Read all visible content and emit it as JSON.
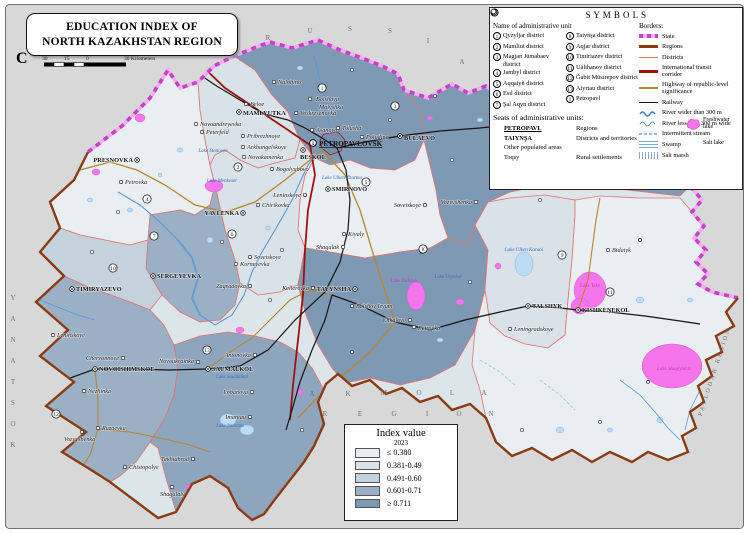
{
  "frame": {
    "title_line1": "EDUCATION INDEX OF",
    "title_line2": "NORTH KAZAKHSTAN REGION",
    "north_letter": "C",
    "scale": {
      "ticks": [
        "30",
        "15",
        "0"
      ],
      "right_label": "30 Kilometers"
    }
  },
  "symbols_panel": {
    "title": "S Y M B O L S",
    "admin_header": "Name of administrative unit",
    "districts_col1": [
      {
        "num": "1",
        "label": "Qyzyljar district"
      },
      {
        "num": "2",
        "label": "Mamliut district"
      },
      {
        "num": "3",
        "label": "Magjan Jūmabaev district"
      },
      {
        "num": "4",
        "label": "Jambyl district"
      },
      {
        "num": "5",
        "label": "Aqqaiyñ district"
      },
      {
        "num": "6",
        "label": "Esıl district"
      },
      {
        "num": "7",
        "label": "Şal Aqyn district"
      }
    ],
    "districts_col2": [
      {
        "num": "8",
        "label": "Taiynşa district"
      },
      {
        "num": "9",
        "label": "Aqjar district"
      },
      {
        "num": "10",
        "label": "Timiriazev district"
      },
      {
        "num": "11",
        "label": "Uälihanov district"
      },
      {
        "num": "12",
        "label": "Ğabit Müsırepov district"
      },
      {
        "num": "13",
        "label": "Aiyrtau district"
      },
      {
        "num": "I",
        "label": "Petropavl"
      }
    ],
    "seats_header": "Seats of administrative units:",
    "seats": [
      {
        "symbol": "region-seat",
        "sample": "PETROPAVL",
        "desc": "Regions"
      },
      {
        "symbol": "district-seat",
        "sample": "TAIYNŞA",
        "desc": "Districts and territories"
      }
    ],
    "other_line": "Other populated areas",
    "rural": {
      "symbol": "village",
      "sample": "Toqsy",
      "desc": "Rural settlements"
    },
    "borders_header": "Borders:",
    "border_items": [
      {
        "type": "state",
        "label": "State"
      },
      {
        "type": "regions",
        "label": "Regions"
      },
      {
        "type": "districts",
        "label": "Districts"
      },
      {
        "type": "transit",
        "label": "International transit corridor"
      },
      {
        "type": "highway",
        "label": "Highway of republic-level significance"
      },
      {
        "type": "railway",
        "label": "Railway"
      },
      {
        "type": "river-wide",
        "label": "River wider than 300 m"
      },
      {
        "type": "river-narrow",
        "label": "River less than 300 m wide"
      },
      {
        "type": "stream",
        "label": "Intermittent stream"
      },
      {
        "type": "swamp",
        "label": "Swamp"
      },
      {
        "type": "saltmarsh",
        "label": "Salt marsh"
      }
    ],
    "lake_items": [
      {
        "type": "fresh",
        "label": "Freshwater lake"
      },
      {
        "type": "salt",
        "label": "Salt lake"
      }
    ]
  },
  "index_legend": {
    "title": "Index value",
    "year": "2023",
    "classes": [
      {
        "label": "≤ 0.380",
        "color": "#e8eef1"
      },
      {
        "label": "0.381-0.49",
        "color": "#d9e2e8"
      },
      {
        "label": "0.491-0.60",
        "color": "#c3d2dc"
      },
      {
        "label": "0.601-0.71",
        "color": "#9ab0c5"
      },
      {
        "label": "≥ 0.711",
        "color": "#7e99b4"
      }
    ]
  },
  "colors": {
    "c1": "#e8eef1",
    "c2": "#d9e2e8",
    "c3": "#c3d2dc",
    "c4": "#9ab0c5",
    "c4b": "#8ea6bd",
    "c5": "#7e99b4",
    "base": "#dce5ea",
    "bg": "#d8d8d8",
    "water_fill": "#bbdcf2",
    "water_stroke": "#78abd8",
    "river": "#5a98d9",
    "salt_fill": "#f476ea",
    "salt_stroke": "#d94fd0",
    "state_dash": "#c83fca",
    "state_band": "#f2aeee",
    "region_border": "#8a3b12",
    "district_border": "#e0746e",
    "corridor": "#9e120e",
    "highway": "#b98530",
    "railway": "#141414"
  },
  "neighbors": {
    "russia": [
      [
        "R",
        268,
        40
      ],
      [
        "U",
        310,
        33
      ],
      [
        "S",
        350,
        31
      ],
      [
        "S",
        390,
        33
      ],
      [
        "I",
        428,
        43
      ],
      [
        "A",
        462,
        64
      ]
    ],
    "akmola_row1": [
      [
        "A",
        312,
        396
      ],
      [
        "K",
        348,
        396
      ],
      [
        "M",
        384,
        395
      ],
      [
        "O",
        419,
        395
      ],
      [
        "L",
        452,
        395
      ],
      [
        "A",
        484,
        395
      ]
    ],
    "akmola_row2": [
      [
        "R",
        325,
        416
      ],
      [
        "E",
        360,
        416
      ],
      [
        "G",
        394,
        416
      ],
      [
        "I",
        427,
        416
      ],
      [
        "O",
        459,
        416
      ],
      [
        "N",
        491,
        416
      ]
    ],
    "kostanay": [
      [
        "Y",
        13,
        300
      ],
      [
        "A",
        13,
        321
      ],
      [
        "N",
        13,
        342
      ],
      [
        "A",
        13,
        363
      ],
      [
        "T",
        13,
        384
      ],
      [
        "S",
        13,
        405
      ],
      [
        "O",
        13,
        426
      ],
      [
        "K",
        13,
        447
      ]
    ],
    "pavlodar": {
      "text": "PAVLODAR REGION",
      "x": 716,
      "y": 372,
      "rot": -72
    }
  },
  "map_features": {
    "towns": [
      {
        "n": "PETROPAVLOVSK",
        "x": 313,
        "y": 143,
        "t": "city",
        "lx": 319,
        "ly": 146
      },
      {
        "n": "BESKOL",
        "x": 303,
        "y": 150,
        "t": "seat",
        "lx": 300,
        "ly": 159
      },
      {
        "n": "MAMLYUTKA",
        "x": 239,
        "y": 112,
        "t": "seat",
        "lx": 243,
        "ly": 115
      },
      {
        "n": "BULAEVO",
        "x": 400,
        "y": 136,
        "t": "seat",
        "lx": 404,
        "ly": 140
      },
      {
        "n": "PRESNOVKA",
        "x": 137,
        "y": 160,
        "t": "seat",
        "lx": 133,
        "ly": 162,
        "a": "end"
      },
      {
        "n": "SMIRNOVO",
        "x": 328,
        "y": 189,
        "t": "seat",
        "lx": 332,
        "ly": 191
      },
      {
        "n": "YAVLENKA",
        "x": 243,
        "y": 213,
        "t": "seat",
        "lx": 239,
        "ly": 215,
        "a": "end"
      },
      {
        "n": "SERGEYEVKA",
        "x": 153,
        "y": 276,
        "t": "seat",
        "lx": 157,
        "ly": 278
      },
      {
        "n": "TAYYNSHA",
        "x": 355,
        "y": 289,
        "t": "seat",
        "lx": 351,
        "ly": 291,
        "a": "end"
      },
      {
        "n": "TIMIRYAZEVO",
        "x": 72,
        "y": 289,
        "t": "seat",
        "lx": 76,
        "ly": 291
      },
      {
        "n": "NOVOISHIMSKOE",
        "x": 95,
        "y": 369,
        "t": "seat",
        "lx": 99,
        "ly": 371
      },
      {
        "n": "SAUMALKOL",
        "x": 208,
        "y": 369,
        "t": "seat",
        "lx": 212,
        "ly": 371
      },
      {
        "n": "TALSHYK",
        "x": 528,
        "y": 306,
        "t": "seat",
        "lx": 532,
        "ly": 308
      },
      {
        "n": "KISHKENEKOL",
        "x": 578,
        "y": 310,
        "t": "seat",
        "lx": 582,
        "ly": 312
      },
      {
        "n": "Nalobino",
        "x": 274,
        "y": 82,
        "t": "vil",
        "lx": 278,
        "ly": 84
      },
      {
        "n": "Beloe",
        "x": 246,
        "y": 104,
        "t": "vil",
        "lx": 250,
        "ly": 106
      },
      {
        "n": "Voskresenovka",
        "x": 296,
        "y": 113,
        "t": "vil",
        "lx": 300,
        "ly": 115
      },
      {
        "n": "Bolshaya",
        "n2": "Malyshka",
        "x": 310,
        "y": 99,
        "lx": 316,
        "ly": 101,
        "l2x": 319,
        "l2y": 109,
        "t": "vil"
      },
      {
        "n": "Pribrezhnoye",
        "x": 243,
        "y": 136,
        "t": "vil",
        "lx": 247,
        "ly": 138
      },
      {
        "n": "Asanovo",
        "x": 312,
        "y": 130,
        "t": "vil",
        "lx": 316,
        "ly": 132
      },
      {
        "n": "Tolusha",
        "x": 338,
        "y": 128,
        "t": "vil",
        "lx": 342,
        "ly": 130
      },
      {
        "n": "Poludino",
        "x": 362,
        "y": 137,
        "t": "vil",
        "lx": 366,
        "ly": 139
      },
      {
        "n": "Arkhangelskoye",
        "x": 243,
        "y": 147,
        "t": "vil",
        "lx": 247,
        "ly": 149
      },
      {
        "n": "Novokamenka",
        "x": 244,
        "y": 157,
        "t": "vil",
        "lx": 248,
        "ly": 159
      },
      {
        "n": "Novoandreyevka",
        "x": 196,
        "y": 124,
        "t": "vil",
        "lx": 200,
        "ly": 126
      },
      {
        "n": "Peterfeld",
        "x": 202,
        "y": 132,
        "t": "vil",
        "lx": 206,
        "ly": 134
      },
      {
        "n": "Bogolyubovo",
        "x": 272,
        "y": 169,
        "t": "vil",
        "lx": 276,
        "ly": 171
      },
      {
        "n": "Leninskoye",
        "x": 305,
        "y": 195,
        "t": "vil",
        "lx": 301,
        "ly": 197,
        "a": "end"
      },
      {
        "n": "Chirikovka",
        "x": 258,
        "y": 205,
        "t": "vil",
        "lx": 262,
        "ly": 207
      },
      {
        "n": "Kiyaly",
        "x": 344,
        "y": 234,
        "t": "vil",
        "lx": 348,
        "ly": 236
      },
      {
        "n": "Shagalak",
        "x": 343,
        "y": 247,
        "t": "vil",
        "lx": 339,
        "ly": 249,
        "a": "end"
      },
      {
        "n": "Sovetskoye",
        "x": 250,
        "y": 257,
        "t": "vil",
        "lx": 254,
        "ly": 259
      },
      {
        "n": "Korneyevka",
        "x": 236,
        "y": 264,
        "t": "vil",
        "lx": 240,
        "ly": 266
      },
      {
        "n": "Zagradovka",
        "x": 250,
        "y": 286,
        "t": "vil",
        "lx": 246,
        "ly": 288,
        "a": "end"
      },
      {
        "n": "Kellerovka",
        "x": 313,
        "y": 288,
        "t": "vil",
        "lx": 309,
        "ly": 290,
        "a": "end"
      },
      {
        "n": "Bolshoy Izyum",
        "x": 352,
        "y": 306,
        "t": "vil",
        "lx": 356,
        "ly": 308
      },
      {
        "n": "Chkalovo",
        "x": 410,
        "y": 320,
        "t": "vil",
        "lx": 406,
        "ly": 322,
        "a": "end"
      },
      {
        "n": "Petrovka",
        "x": 414,
        "y": 327,
        "t": "vil",
        "lx": 418,
        "ly": 330
      },
      {
        "n": "Sovetskoye",
        "x": 425,
        "y": 205,
        "t": "vil",
        "lx": 421,
        "ly": 207,
        "a": "end"
      },
      {
        "n": "Vozvyshenka",
        "x": 476,
        "y": 202,
        "t": "vil",
        "lx": 472,
        "ly": 204,
        "a": "end"
      },
      {
        "n": "Bidaiyk",
        "x": 608,
        "y": 250,
        "t": "vil",
        "lx": 612,
        "ly": 252
      },
      {
        "n": "Leningradskoye",
        "x": 510,
        "y": 329,
        "t": "vil",
        "lx": 514,
        "ly": 331
      },
      {
        "n": "Chervonnoye",
        "x": 123,
        "y": 358,
        "t": "vil",
        "lx": 119,
        "ly": 360,
        "a": "end"
      },
      {
        "n": "Leninskoye",
        "x": 53,
        "y": 335,
        "t": "vil",
        "lx": 57,
        "ly": 337
      },
      {
        "n": "Nezhinka",
        "x": 84,
        "y": 391,
        "t": "vil",
        "lx": 88,
        "ly": 393
      },
      {
        "n": "Novoukrainka",
        "x": 198,
        "y": 362,
        "t": "vil",
        "lx": 194,
        "ly": 363,
        "a": "end"
      },
      {
        "n": "Antonovka",
        "x": 255,
        "y": 355,
        "t": "vil",
        "lx": 251,
        "ly": 357,
        "a": "end"
      },
      {
        "n": "Lobanova",
        "x": 252,
        "y": 392,
        "t": "vil",
        "lx": 248,
        "ly": 394,
        "a": "end"
      },
      {
        "n": "Imantau",
        "x": 250,
        "y": 417,
        "t": "vil",
        "lx": 246,
        "ly": 419,
        "a": "end"
      },
      {
        "n": "Ruzaevka",
        "x": 98,
        "y": 428,
        "t": "vil",
        "lx": 102,
        "ly": 430
      },
      {
        "n": "Vozvyshenka",
        "x": 82,
        "y": 432,
        "t": "vil",
        "lx": 64,
        "ly": 441
      },
      {
        "n": "Chistopolye",
        "x": 125,
        "y": 467,
        "t": "vil",
        "lx": 129,
        "ly": 469
      },
      {
        "n": "Takhtabrod",
        "x": 193,
        "y": 459,
        "t": "vil",
        "lx": 189,
        "ly": 461,
        "a": "end"
      },
      {
        "n": "Shagalaly",
        "x": 172,
        "y": 487,
        "t": "vil",
        "lx": 160,
        "ly": 496
      },
      {
        "n": "Petrovka",
        "x": 121,
        "y": 182,
        "t": "vil",
        "lx": 125,
        "ly": 184
      }
    ],
    "dots": [
      [
        352,
        70
      ],
      [
        390,
        120
      ],
      [
        452,
        160
      ],
      [
        500,
        152
      ],
      [
        558,
        140
      ],
      [
        620,
        142
      ],
      [
        662,
        152
      ],
      [
        282,
        250
      ],
      [
        222,
        242
      ],
      [
        118,
        212
      ],
      [
        92,
        252
      ],
      [
        422,
        252
      ],
      [
        470,
        282
      ],
      [
        352,
        352
      ],
      [
        302,
        430
      ],
      [
        522,
        430
      ],
      [
        600,
        422
      ],
      [
        648,
        382
      ],
      [
        270,
        300
      ],
      [
        435,
        96
      ],
      [
        540,
        200
      ],
      [
        640,
        240
      ]
    ],
    "district_numbers": [
      {
        "n": "1",
        "x": 322,
        "y": 88
      },
      {
        "n": "2",
        "x": 238,
        "y": 167
      },
      {
        "n": "3",
        "x": 395,
        "y": 106
      },
      {
        "n": "4",
        "x": 147,
        "y": 199
      },
      {
        "n": "5",
        "x": 366,
        "y": 182
      },
      {
        "n": "6",
        "x": 232,
        "y": 234
      },
      {
        "n": "7",
        "x": 154,
        "y": 236
      },
      {
        "n": "8",
        "x": 423,
        "y": 249
      },
      {
        "n": "9",
        "x": 562,
        "y": 255
      },
      {
        "n": "10",
        "x": 113,
        "y": 268
      },
      {
        "n": "11",
        "x": 610,
        "y": 292
      },
      {
        "n": "12",
        "x": 56,
        "y": 414
      },
      {
        "n": "13",
        "x": 207,
        "y": 350
      }
    ],
    "lake_labels": [
      {
        "n": "Lake Stanovoe",
        "x": 213,
        "y": 152,
        "c": "fresh"
      },
      {
        "n": "Lake Menkeser",
        "x": 222,
        "y": 182,
        "c": "fresh"
      },
      {
        "n": "Lake Ulken Zharma",
        "x": 342,
        "y": 179,
        "c": "fresh"
      },
      {
        "n": "Lake Ulken Karaoi",
        "x": 524,
        "y": 251,
        "c": "fresh"
      },
      {
        "n": "Lake Kalibek",
        "x": 404,
        "y": 282,
        "c": "salt"
      },
      {
        "n": "Lake Uzynkol",
        "x": 448,
        "y": 278,
        "c": "fresh"
      },
      {
        "n": "Lake Teke",
        "x": 590,
        "y": 287,
        "c": "salt"
      },
      {
        "n": "Lake Shaglyteniz",
        "x": 674,
        "y": 370,
        "c": "salt"
      },
      {
        "n": "Lake Imantau",
        "x": 230,
        "y": 427,
        "c": "fresh"
      },
      {
        "n": "Lake Saumalkol",
        "x": 232,
        "y": 378,
        "c": "fresh"
      }
    ]
  }
}
